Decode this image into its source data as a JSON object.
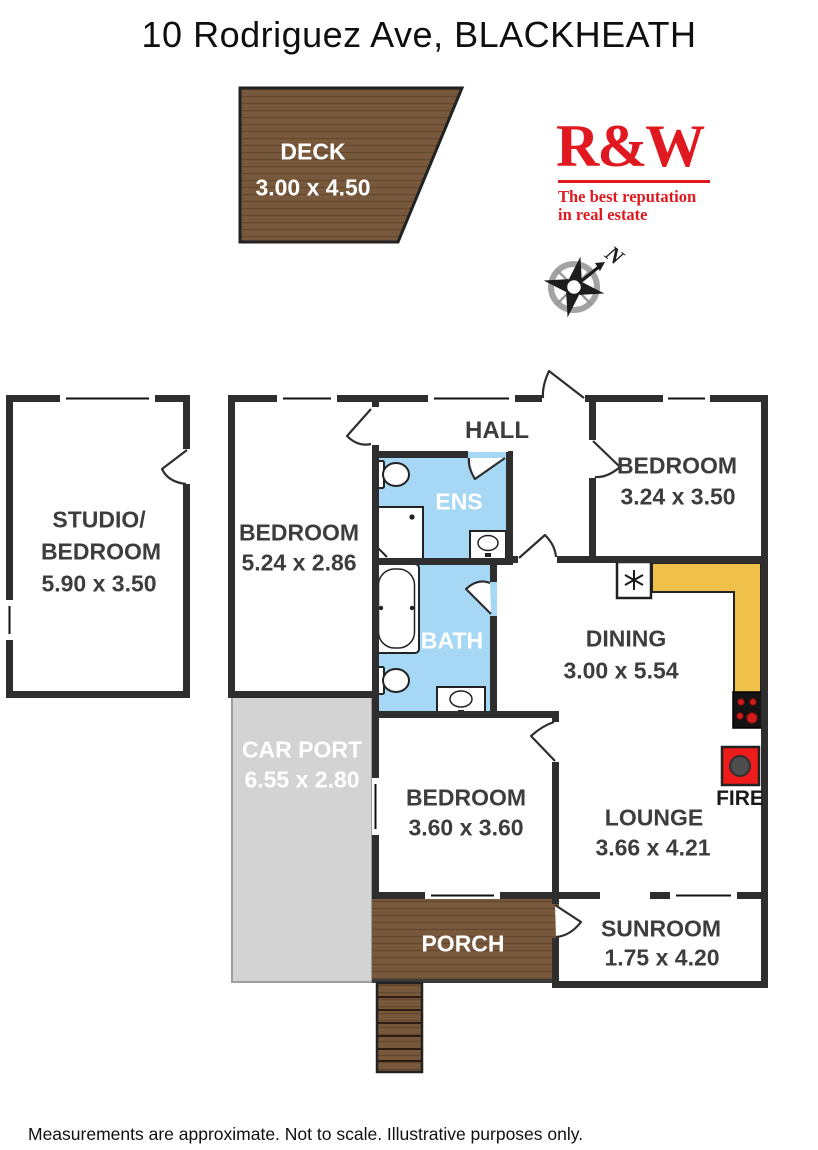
{
  "title": "10 Rodriguez Ave, BLACKHEATH",
  "logo": {
    "brand": "R&W",
    "tagline_line1": "The best reputation",
    "tagline_line2": "in real estate",
    "color": "#e0181f"
  },
  "compass": {
    "north_label": "N"
  },
  "rooms": {
    "deck": {
      "name": "DECK",
      "dims": "3.00 x 4.50"
    },
    "studio": {
      "name_line1": "STUDIO/",
      "name_line2": "BEDROOM",
      "dims": "5.90 x 3.50"
    },
    "bedroom1": {
      "name": "BEDROOM",
      "dims": "5.24 x 2.86"
    },
    "hall": {
      "name": "HALL"
    },
    "ens": {
      "name": "ENS"
    },
    "bath": {
      "name": "BATH"
    },
    "bedroom2": {
      "name": "BEDROOM",
      "dims": "3.24 x 3.50"
    },
    "dining": {
      "name": "DINING",
      "dims": "3.00 x 5.54"
    },
    "carport": {
      "name": "CAR PORT",
      "dims": "6.55 x 2.80"
    },
    "bedroom3": {
      "name": "BEDROOM",
      "dims": "3.60 x 3.60"
    },
    "lounge": {
      "name": "LOUNGE",
      "dims": "3.66 x 4.21"
    },
    "fire": {
      "label": "FIRE"
    },
    "porch": {
      "name": "PORCH"
    },
    "sunroom": {
      "name": "SUNROOM",
      "dims": "1.75 x 4.20"
    }
  },
  "colors": {
    "wall": "#2e2e2e",
    "wet_area_blue": "#a6d8f6",
    "kitchen_counter_yellow": "#efc04a",
    "carport_gray": "#d3d3d3",
    "wood_brown": "#7a5a3c",
    "wood_grain": "#65492f",
    "fire_red": "#ee1b1b",
    "logo_red": "#e0181f"
  },
  "footer": "Measurements are approximate. Not to scale. Illustrative purposes only."
}
